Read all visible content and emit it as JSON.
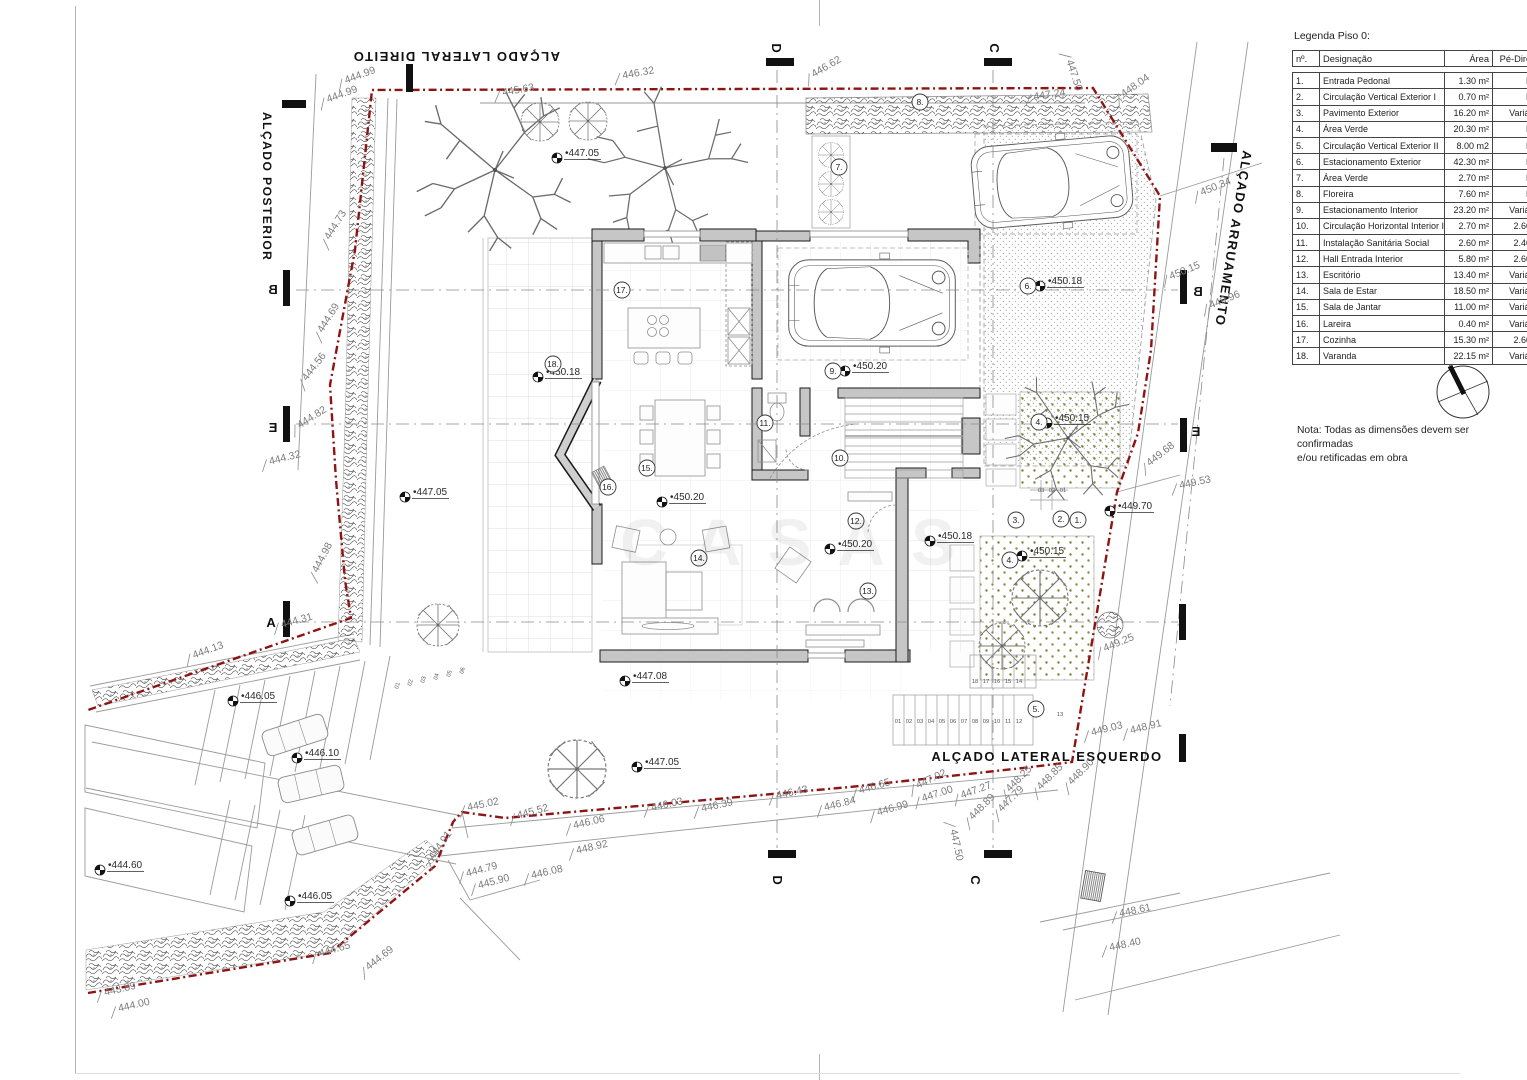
{
  "legend": {
    "title": "Legenda Piso 0:",
    "columns": [
      "nº.",
      "Designação",
      "Área",
      "Pé-Direito"
    ],
    "rows": [
      [
        "1.",
        "Entrada Pedonal",
        "1.30 m²",
        "N/A"
      ],
      [
        "2.",
        "Circulação Vertical Exterior I",
        "0.70 m²",
        "N/A"
      ],
      [
        "3.",
        "Pavimento Exterior",
        "16.20 m²",
        "Variável"
      ],
      [
        "4.",
        "Área Verde",
        "20.30 m²",
        "N/A"
      ],
      [
        "5.",
        "Circulação Vertical Exterior II",
        "8.00 m2",
        "N/A"
      ],
      [
        "6.",
        "Estacionamento Exterior",
        "42.30 m²",
        "N/A"
      ],
      [
        "7.",
        "Área Verde",
        "2.70 m²",
        "N/A"
      ],
      [
        "8.",
        "Floreira",
        "7.60 m²",
        "N/A"
      ],
      [
        "9.",
        "Estacionamento Interior",
        "23.20 m²",
        "Variável"
      ],
      [
        "10.",
        "Circulação Horizontal Interior I",
        "2.70 m²",
        "2.60 m"
      ],
      [
        "11.",
        "Instalação Sanitária Social",
        "2.60 m²",
        "2.40 m"
      ],
      [
        "12.",
        "Hall Entrada Interior",
        "5.80 m²",
        "2.60 m"
      ],
      [
        "13.",
        "Escritório",
        "13.40 m²",
        "Variável"
      ],
      [
        "14.",
        "Sala de Estar",
        "18.50 m²",
        "Variável"
      ],
      [
        "15.",
        "Sala de Jantar",
        "11.00 m²",
        "Variável"
      ],
      [
        "16.",
        "Lareira",
        "0.40 m²",
        "Variável"
      ],
      [
        "17.",
        "Cozinha",
        "15.30 m²",
        "2.60 m"
      ],
      [
        "18.",
        "Varanda",
        "22.15 m²",
        "Variável"
      ]
    ]
  },
  "north": {
    "label": "N"
  },
  "note": {
    "line1": "Nota: Todas as dimensões devem ser confirmadas",
    "line2": "e/ou retificadas em obra"
  },
  "watermark": "CASAS",
  "titles": [
    {
      "id": "title-lateral-direito",
      "text": "ALÇADO LATERAL DIREITO",
      "x": 560,
      "y": 52,
      "rot": 180,
      "size": 13
    },
    {
      "id": "title-posterior",
      "text": "ALÇADO POSTERIOR",
      "x": 263,
      "y": 112,
      "rot": 90,
      "size": 12
    },
    {
      "id": "title-arruamento",
      "text": "ALÇADO ARRUAMENTO",
      "x": 1243,
      "y": 150,
      "rot": 99,
      "size": 13
    },
    {
      "id": "title-lateral-esquerdo",
      "text": "ALÇADO LATERAL ESQUERDO",
      "x": 1047,
      "y": 761,
      "rot": 0,
      "size": 13
    }
  ],
  "section_labels": [
    {
      "t": "A",
      "x": 271,
      "y": 627,
      "rot": 0,
      "mir": false
    },
    {
      "t": "B",
      "x": 273,
      "y": 294,
      "rot": 0,
      "mir": true
    },
    {
      "t": "B",
      "x": 1198,
      "y": 296,
      "rot": 0,
      "mir": true
    },
    {
      "t": "E",
      "x": 273,
      "y": 432,
      "rot": 0,
      "mir": true
    },
    {
      "t": "E",
      "x": 1196,
      "y": 436,
      "rot": 0,
      "mir": true
    },
    {
      "t": "C",
      "x": 999,
      "y": 48,
      "rot": -90,
      "mir": true
    },
    {
      "t": "C",
      "x": 980,
      "y": 880,
      "rot": -90,
      "mir": true
    },
    {
      "t": "D",
      "x": 781,
      "y": 48,
      "rot": -90,
      "mir": true
    },
    {
      "t": "D",
      "x": 782,
      "y": 880,
      "rot": -90,
      "mir": true
    }
  ],
  "section_bars": [
    [
      283,
      601,
      7,
      36
    ],
    [
      1179,
      604,
      7,
      36
    ],
    [
      283,
      270,
      7,
      36
    ],
    [
      1180,
      270,
      7,
      34
    ],
    [
      283,
      406,
      7,
      36
    ],
    [
      1180,
      418,
      7,
      34
    ],
    [
      984,
      58,
      28,
      8
    ],
    [
      984,
      850,
      28,
      8
    ],
    [
      766,
      58,
      28,
      8
    ],
    [
      768,
      850,
      28,
      8
    ],
    [
      406,
      64,
      7,
      28
    ],
    [
      282,
      100,
      24,
      8
    ],
    [
      1211,
      143,
      26,
      9
    ],
    [
      1179,
      734,
      7,
      28
    ]
  ],
  "dash_lines": [
    [
      296,
      290,
      1178,
      290
    ],
    [
      296,
      424,
      1178,
      424
    ],
    [
      296,
      622,
      1178,
      622
    ],
    [
      777,
      70,
      777,
      848
    ],
    [
      993,
      70,
      993,
      848
    ],
    [
      1224,
      158,
      1170,
      706
    ]
  ],
  "room_markers": [
    {
      "n": "1.",
      "x": 1078,
      "y": 520
    },
    {
      "n": "2.",
      "x": 1061,
      "y": 519
    },
    {
      "n": "3.",
      "x": 1016,
      "y": 520
    },
    {
      "n": "4.",
      "x": 1039,
      "y": 422
    },
    {
      "n": "4.",
      "x": 1010,
      "y": 560
    },
    {
      "n": "5.",
      "x": 1036,
      "y": 709
    },
    {
      "n": "6.",
      "x": 1028,
      "y": 286
    },
    {
      "n": "7.",
      "x": 839,
      "y": 167
    },
    {
      "n": "8.",
      "x": 920,
      "y": 102
    },
    {
      "n": "9.",
      "x": 833,
      "y": 371
    },
    {
      "n": "10.",
      "x": 840,
      "y": 458
    },
    {
      "n": "11.",
      "x": 765,
      "y": 423
    },
    {
      "n": "12.",
      "x": 856,
      "y": 521
    },
    {
      "n": "13.",
      "x": 868,
      "y": 591
    },
    {
      "n": "14.",
      "x": 699,
      "y": 558
    },
    {
      "n": "15.",
      "x": 647,
      "y": 468
    },
    {
      "n": "16.",
      "x": 608,
      "y": 487
    },
    {
      "n": "17.",
      "x": 622,
      "y": 290
    },
    {
      "n": "18.",
      "x": 553,
      "y": 364
    }
  ],
  "spot_elevations": [
    {
      "v": "447.05",
      "x": 557,
      "y": 158
    },
    {
      "v": "447.05",
      "x": 405,
      "y": 497
    },
    {
      "v": "447.05",
      "x": 637,
      "y": 767
    },
    {
      "v": "450.18",
      "x": 538,
      "y": 377
    },
    {
      "v": "450.20",
      "x": 662,
      "y": 502
    },
    {
      "v": "450.20",
      "x": 845,
      "y": 371
    },
    {
      "v": "450.20",
      "x": 830,
      "y": 549
    },
    {
      "v": "450.18",
      "x": 1040,
      "y": 286
    },
    {
      "v": "450.18",
      "x": 930,
      "y": 541
    },
    {
      "v": "450.15",
      "x": 1047,
      "y": 423
    },
    {
      "v": "450.15",
      "x": 1022,
      "y": 556
    },
    {
      "v": "449.70",
      "x": 1110,
      "y": 511
    },
    {
      "v": "447.08",
      "x": 625,
      "y": 681
    },
    {
      "v": "446.05",
      "x": 233,
      "y": 701
    },
    {
      "v": "446.10",
      "x": 297,
      "y": 758
    },
    {
      "v": "444.60",
      "x": 100,
      "y": 870
    },
    {
      "v": "446.05",
      "x": 290,
      "y": 901
    }
  ],
  "dim_labels": [
    {
      "v": "444.99",
      "x": 345,
      "y": 84,
      "r": -20
    },
    {
      "v": "444.99",
      "x": 327,
      "y": 103,
      "r": -20
    },
    {
      "v": "445.63",
      "x": 502,
      "y": 96,
      "r": -10
    },
    {
      "v": "446.32",
      "x": 622,
      "y": 79,
      "r": -10
    },
    {
      "v": "446.62",
      "x": 813,
      "y": 78,
      "r": -30
    },
    {
      "v": "447.24",
      "x": 1033,
      "y": 100,
      "r": -8
    },
    {
      "v": "448.04",
      "x": 1123,
      "y": 98,
      "r": -35
    },
    {
      "v": "447.50",
      "x": 1066,
      "y": 60,
      "r": 72
    },
    {
      "v": "450.34",
      "x": 1201,
      "y": 196,
      "r": -22
    },
    {
      "v": "450.15",
      "x": 1170,
      "y": 280,
      "r": -22
    },
    {
      "v": "449.96",
      "x": 1210,
      "y": 309,
      "r": -22
    },
    {
      "v": "449.68",
      "x": 1149,
      "y": 467,
      "r": -38
    },
    {
      "v": "449.53",
      "x": 1179,
      "y": 489,
      "r": -12
    },
    {
      "v": "449.25",
      "x": 1104,
      "y": 652,
      "r": -22
    },
    {
      "v": "449.03",
      "x": 1091,
      "y": 736,
      "r": -14
    },
    {
      "v": "448.91",
      "x": 1130,
      "y": 734,
      "r": -14
    },
    {
      "v": "448.61",
      "x": 1119,
      "y": 917,
      "r": -12
    },
    {
      "v": "448.40",
      "x": 1109,
      "y": 951,
      "r": -12
    },
    {
      "v": "448.90",
      "x": 1071,
      "y": 786,
      "r": -45
    },
    {
      "v": "448.85",
      "x": 1040,
      "y": 791,
      "r": -45
    },
    {
      "v": "448.25",
      "x": 1009,
      "y": 793,
      "r": -45
    },
    {
      "v": "447.79",
      "x": 1001,
      "y": 813,
      "r": -45
    },
    {
      "v": "448.89",
      "x": 972,
      "y": 821,
      "r": -45
    },
    {
      "v": "447.27",
      "x": 961,
      "y": 799,
      "r": -20
    },
    {
      "v": "447.02",
      "x": 917,
      "y": 789,
      "r": -25
    },
    {
      "v": "447.00",
      "x": 922,
      "y": 802,
      "r": -18
    },
    {
      "v": "446.99",
      "x": 877,
      "y": 816,
      "r": -16
    },
    {
      "v": "446.65",
      "x": 859,
      "y": 794,
      "r": -16
    },
    {
      "v": "446.84",
      "x": 824,
      "y": 811,
      "r": -14
    },
    {
      "v": "446.43",
      "x": 776,
      "y": 799,
      "r": -12
    },
    {
      "v": "446.39",
      "x": 701,
      "y": 812,
      "r": -12
    },
    {
      "v": "446.03",
      "x": 651,
      "y": 811,
      "r": -12
    },
    {
      "v": "446.06",
      "x": 573,
      "y": 829,
      "r": -13
    },
    {
      "v": "445.52",
      "x": 517,
      "y": 819,
      "r": -15
    },
    {
      "v": "445.02",
      "x": 467,
      "y": 811,
      "r": -12
    },
    {
      "v": "448.92",
      "x": 576,
      "y": 854,
      "r": -13
    },
    {
      "v": "446.08",
      "x": 531,
      "y": 879,
      "r": -13
    },
    {
      "v": "445.90",
      "x": 478,
      "y": 889,
      "r": -15
    },
    {
      "v": "444.79",
      "x": 466,
      "y": 877,
      "r": -15
    },
    {
      "v": "444.91",
      "x": 433,
      "y": 861,
      "r": -55
    },
    {
      "v": "447.50",
      "x": 950,
      "y": 829,
      "r": 78
    },
    {
      "v": "444.65",
      "x": 319,
      "y": 957,
      "r": -16
    },
    {
      "v": "444.69",
      "x": 368,
      "y": 971,
      "r": -38
    },
    {
      "v": "443.89",
      "x": 104,
      "y": 996,
      "r": -13
    },
    {
      "v": "444.00",
      "x": 118,
      "y": 1012,
      "r": -13
    },
    {
      "v": "444.73",
      "x": 329,
      "y": 241,
      "r": -58
    },
    {
      "v": "444.69",
      "x": 322,
      "y": 334,
      "r": -58
    },
    {
      "v": "444.56",
      "x": 306,
      "y": 382,
      "r": -52
    },
    {
      "v": "444.82",
      "x": 299,
      "y": 429,
      "r": -32
    },
    {
      "v": "444.32",
      "x": 269,
      "y": 465,
      "r": -14
    },
    {
      "v": "444.98",
      "x": 317,
      "y": 574,
      "r": -62
    },
    {
      "v": "444.31",
      "x": 281,
      "y": 628,
      "r": -15
    },
    {
      "v": "444.13",
      "x": 193,
      "y": 659,
      "r": -20
    }
  ],
  "step_numbers": [
    {
      "t": "01",
      "x": 898,
      "y": 723
    },
    {
      "t": "02",
      "x": 909,
      "y": 723
    },
    {
      "t": "03",
      "x": 920,
      "y": 723
    },
    {
      "t": "04",
      "x": 931,
      "y": 723
    },
    {
      "t": "05",
      "x": 942,
      "y": 723
    },
    {
      "t": "06",
      "x": 953,
      "y": 723
    },
    {
      "t": "07",
      "x": 964,
      "y": 723
    },
    {
      "t": "08",
      "x": 975,
      "y": 723
    },
    {
      "t": "09",
      "x": 986,
      "y": 723
    },
    {
      "t": "10",
      "x": 997,
      "y": 723
    },
    {
      "t": "11",
      "x": 1008,
      "y": 723
    },
    {
      "t": "12",
      "x": 1019,
      "y": 723
    },
    {
      "t": "18",
      "x": 975,
      "y": 683
    },
    {
      "t": "17",
      "x": 986,
      "y": 683
    },
    {
      "t": "16",
      "x": 997,
      "y": 683
    },
    {
      "t": "15",
      "x": 1008,
      "y": 683
    },
    {
      "t": "14",
      "x": 1019,
      "y": 683
    },
    {
      "t": "13",
      "x": 1060,
      "y": 716
    },
    {
      "t": "03",
      "x": 1041,
      "y": 492
    },
    {
      "t": "02",
      "x": 1052,
      "y": 492
    },
    {
      "t": "01",
      "x": 1063,
      "y": 492
    },
    {
      "t": "01",
      "x": 399,
      "y": 686,
      "r": -75
    },
    {
      "t": "02",
      "x": 412,
      "y": 683,
      "r": -75
    },
    {
      "t": "03",
      "x": 425,
      "y": 680,
      "r": -75
    },
    {
      "t": "04",
      "x": 438,
      "y": 677,
      "r": -75
    },
    {
      "t": "05",
      "x": 451,
      "y": 674,
      "r": -75
    },
    {
      "t": "06",
      "x": 464,
      "y": 671,
      "r": -75
    }
  ],
  "colors": {
    "boundary": "#8e1414",
    "walls": "#c6c6c6",
    "lines": "#8a8a8a",
    "greendot": "#7d7d2f"
  }
}
